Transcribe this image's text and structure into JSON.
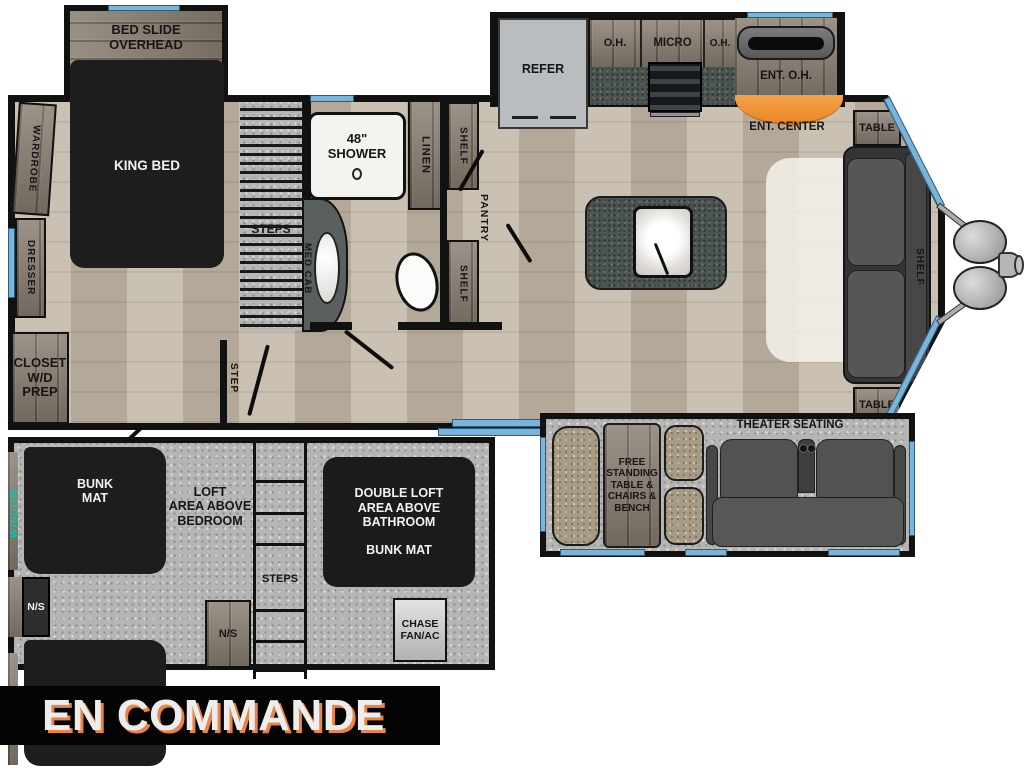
{
  "banner": {
    "text": "EN COMMANDE"
  },
  "colors": {
    "wall": "#111111",
    "window_blue": "#7ab4d8",
    "teal_accent": "#14c2ac",
    "ent_orange": "#ef8f33",
    "banner_shadow": "#ea8440"
  },
  "bedroom": {
    "slide_label": [
      "BED SLIDE",
      "OVERHEAD"
    ],
    "king_bed": "KING BED",
    "wardrobe": "WARDROBE",
    "dresser": "DRESSER",
    "closet": [
      "CLOSET",
      "W/D",
      "PREP"
    ],
    "steps": "STEPS",
    "step": "STEP"
  },
  "bathroom": {
    "shower_line1": "48\"",
    "shower_line2": "SHOWER",
    "med_cab": "MED CAB",
    "linen": "LINEN",
    "shelf_upper": "SHELF",
    "shelf_lower": "SHELF",
    "pantry": "PANTRY"
  },
  "kitchen": {
    "refer": "REFER",
    "oh_left": "O.H.",
    "micro": "MICRO",
    "oh_right": "O.H.",
    "ent_oh": "ENT. O.H.",
    "ent_center": "ENT. CENTER"
  },
  "living": {
    "table_rear": "TABLE",
    "table_front": "TABLE",
    "shelf": "SHELF",
    "theater": "THEATER SEATING",
    "dinette": [
      "FREE",
      "STANDING",
      "TABLE &",
      "CHAIRS &",
      "BENCH"
    ]
  },
  "loft": {
    "escape_window": "ESCAPE WINDOW",
    "window_upper": "WINDOW",
    "window_lower": "WINDOW",
    "bunk1": [
      "BUNK",
      "MAT"
    ],
    "loft_area": [
      "LOFT",
      "AREA ABOVE",
      "BEDROOM"
    ],
    "ns_left": "N/S",
    "ns_right": "N/S",
    "steps": "STEPS",
    "double_loft": [
      "DOUBLE LOFT",
      "AREA ABOVE",
      "BATHROOM"
    ],
    "double_loft_bunk": "BUNK MAT",
    "chase": [
      "CHASE",
      "FAN/AC"
    ]
  }
}
